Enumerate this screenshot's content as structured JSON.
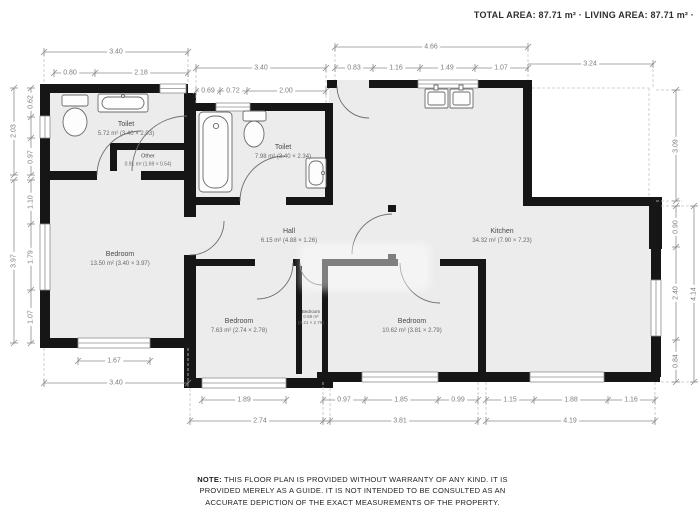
{
  "header": {
    "summary": "TOTAL AREA: 87.71 m² · LIVING AREA: 87.71 m² ·"
  },
  "rooms": [
    {
      "id": "toilet-1",
      "name": "Toilet",
      "size": "5.72 m² (3.40 × 2.03)"
    },
    {
      "id": "other",
      "name": "Other",
      "size": "0.91 m² (1.69 × 0.54)"
    },
    {
      "id": "bedroom-1",
      "name": "Bedroom",
      "size": "13.50 m² (3.40 × 3.97)"
    },
    {
      "id": "toilet-2",
      "name": "Toilet",
      "size": "7.98 m² (3.40 × 2.34)"
    },
    {
      "id": "hall",
      "name": "Hall",
      "size": "6.15 m² (4.88 × 1.26)"
    },
    {
      "id": "kitchen",
      "name": "Kitchen",
      "size": "34.32 m² (7.90 × 7.23)"
    },
    {
      "id": "bedroom-2",
      "name": "Bedroom",
      "size": "7.63 m² (2.74 × 2.78)"
    },
    {
      "id": "closet",
      "name": "Bedroom",
      "size": "0.59 m²",
      "size2": "(0.21 × 2.79)"
    },
    {
      "id": "bedroom-3",
      "name": "Bedroom",
      "size": "10.62 m² (3.81 × 2.79)"
    }
  ],
  "dims": {
    "t1": "3.40",
    "t2": "0.80",
    "t3": "2.18",
    "t4": "3.40",
    "t5": "0.69",
    "t6": "0.72",
    "t7": "2.00",
    "t8": "4.66",
    "t9": "0.83",
    "t10": "1.16",
    "t11": "1.49",
    "t12": "1.07",
    "t13": "3.24",
    "l1": "2.03",
    "l2": "0.62",
    "l3": "0.97",
    "l4": "3.97",
    "l5": "1.10",
    "l6": "1.79",
    "l7": "1.07",
    "r1": "3.09",
    "r2": "0.90",
    "r3": "2.40",
    "r4": "0.84",
    "r5": "4.14",
    "b1": "1.67",
    "b2": "3.40",
    "b3": "1.89",
    "b4": "2.74",
    "b5": "0.97",
    "b6": "1.85",
    "b7": "0.99",
    "b8": "3.81",
    "b9": "1.15",
    "b10": "1.88",
    "b11": "1.16",
    "b12": "4.19"
  },
  "note": {
    "prefix": "NOTE:",
    "body": " THIS FLOOR PLAN IS PROVIDED WITHOUT WARRANTY OF ANY KIND. IT IS PROVIDED MERELY AS A GUIDE. IT IS NOT INTENDED TO BE CONSULTED AS AN ACCURATE DEPICTION OF THE EXACT MEASUREMENTS OF THE PROPERTY."
  },
  "colors": {
    "wall": "#161616",
    "floor": "#ececec",
    "dim_line": "#8c8c8c",
    "text": "#4a4a4a"
  }
}
